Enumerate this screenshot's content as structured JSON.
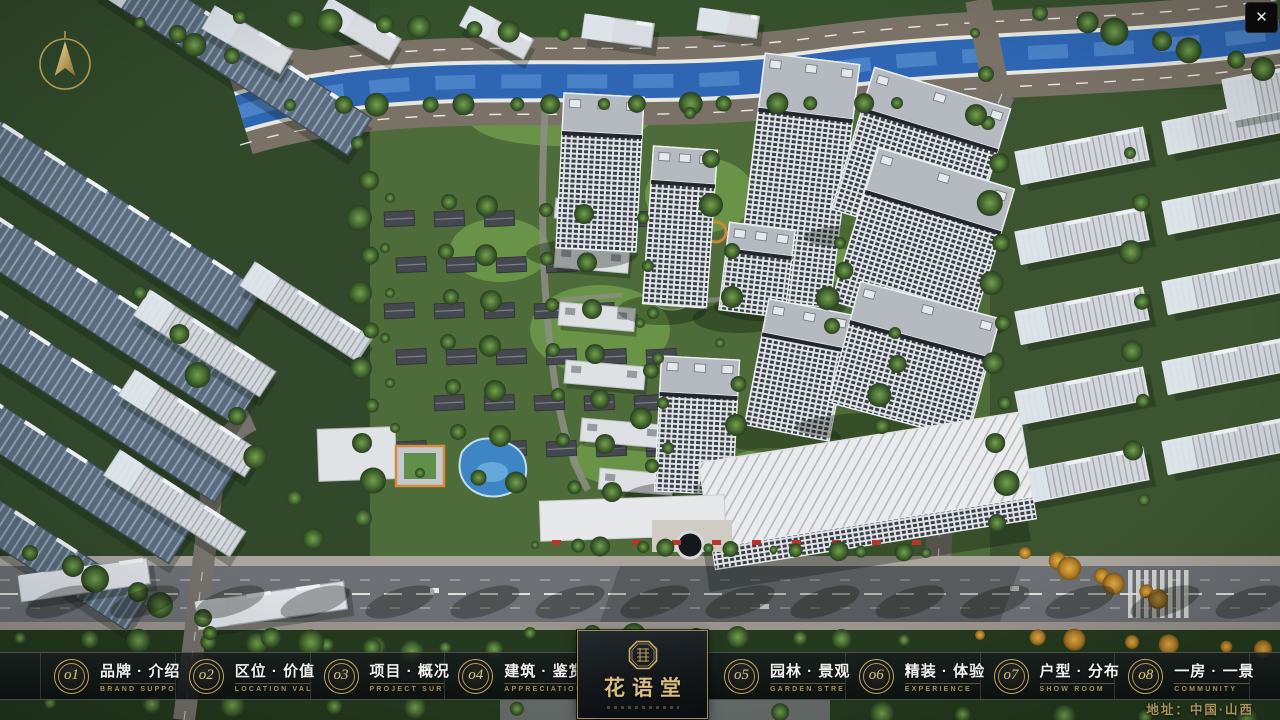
{
  "nav": {
    "items": [
      {
        "num": "o1",
        "cn": "品牌 · 介绍",
        "en": "BRAND SUPPORT"
      },
      {
        "num": "o2",
        "cn": "区位 · 价值",
        "en": "LOCATION VALUE"
      },
      {
        "num": "o3",
        "cn": "项目 · 概况",
        "en": "PROJECT SURVEY"
      },
      {
        "num": "o4",
        "cn": "建筑 · 鉴赏",
        "en": "APPRECIATION"
      },
      {
        "num": "o5",
        "cn": "园林 · 景观",
        "en": "GARDEN STREET"
      },
      {
        "num": "o6",
        "cn": "精装 · 体验",
        "en": "EXPERIENCE"
      },
      {
        "num": "o7",
        "cn": "户型 · 分布",
        "en": "SHOW ROOM"
      },
      {
        "num": "o8",
        "cn": "一房 · 一景",
        "en": "COMMUNITY"
      }
    ]
  },
  "logo": {
    "title": "花语堂"
  },
  "footer": {
    "address": "地址：中国·山西"
  },
  "window": {
    "close_label": "✕"
  },
  "colors": {
    "gold": "#c9ab67",
    "gold_dim": "#a5905c",
    "bar_bg": "#10181a",
    "river": "#2e66b4"
  }
}
